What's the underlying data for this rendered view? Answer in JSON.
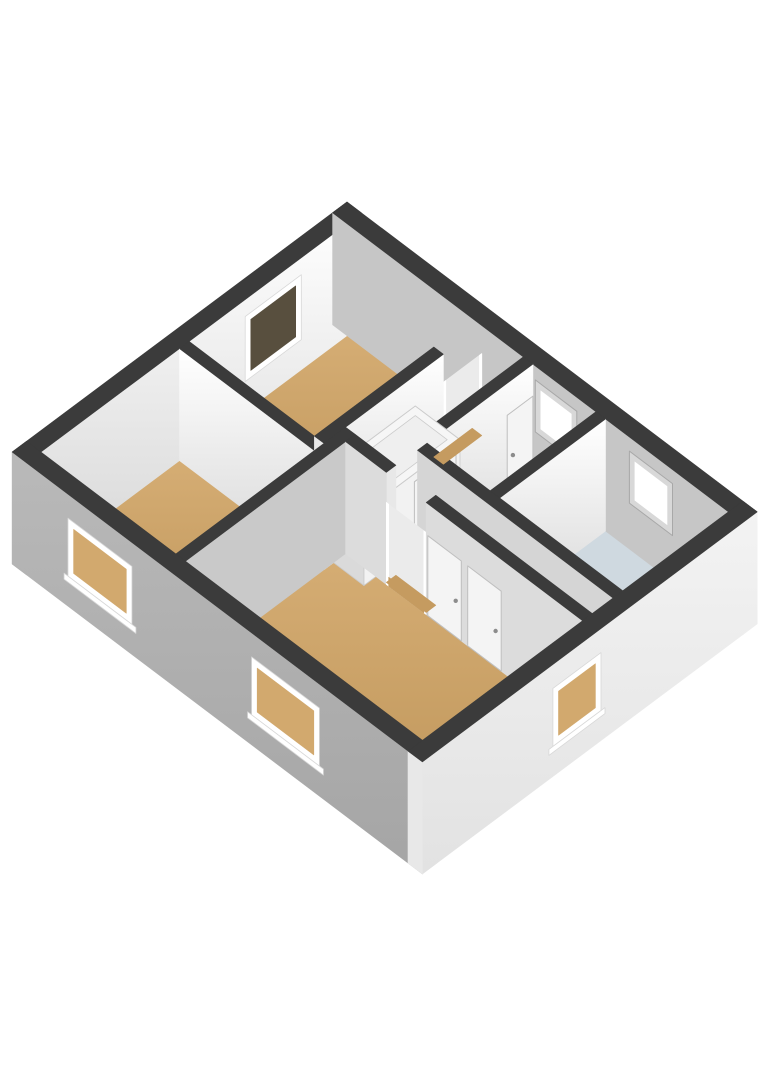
{
  "meta": {
    "view_label": "3d-floorplan-render"
  },
  "canvas": {
    "width": 768,
    "height": 1086,
    "background": "#ffffff"
  },
  "projection": {
    "ox": 347,
    "oy": 202,
    "ux": 0.798,
    "uy": 0.603,
    "vx": -0.801,
    "vy": 0.598,
    "wallH": 112
  },
  "fills": {
    "bg": "#ffffff",
    "wall_top": "#3b3b3b",
    "bright": {
      "grad": [
        "#ffffff",
        "#d6d6d6"
      ]
    },
    "ne_face": "#c6c6c6",
    "gray_face": "#c9c9c9",
    "mid_face": "#dcdcdc",
    "soft_face": "#d5d5d5",
    "sw_ext": {
      "grad": [
        "#b9b9b9",
        "#a5a5a5"
      ]
    },
    "se_ext": {
      "grad": [
        "#f3f3f3",
        "#e2e2e2"
      ]
    },
    "sliver": "#e8e8e8",
    "floor_wood": {
      "grad": [
        "#d5ad74",
        "#bd9458"
      ]
    },
    "floor_hall": "#e2e2e2",
    "floor_bath": "#cfd9e0",
    "glass_dark": "#584f3e",
    "glass_wood": "#d2a96e",
    "glass_white": "#ffffff",
    "frame": "#ffffff",
    "recess": "#d8d8d8",
    "recess_edge": "#a8a8a8",
    "doorway": "#ebebeb",
    "thresh": "#c59b60",
    "leaf": "#f4f4f4",
    "leaf_line": "#bfbfbf",
    "handle": "#8c8c8c",
    "hole": "#c6c6c6",
    "step": "#ffffff",
    "step_line": "#d8d8d8",
    "step_side": "#dadada",
    "step_back": "#f4f4f4",
    "stair_top": "#f6f6f6",
    "stair_inner": "#efefef",
    "stair_edge": "#cbcbcb",
    "stair_px": "#f2f2f2",
    "stair_py": "#dadada"
  },
  "floors": [
    {
      "name": "bedroom-2-floor",
      "fill": "floor_wood",
      "pts": [
        [
          18,
          18
        ],
        [
          175,
          18
        ],
        [
          175,
          215
        ],
        [
          18,
          215
        ]
      ]
    },
    {
      "name": "bedroom-1-floor",
      "fill": "floor_wood",
      "pts": [
        [
          18,
          227
        ],
        [
          187,
          227
        ],
        [
          187,
          400
        ],
        [
          18,
          400
        ]
      ]
    },
    {
      "name": "bedroom-3-floor",
      "fill": "floor_wood",
      "pts": [
        [
          199,
          200
        ],
        [
          496,
          200
        ],
        [
          496,
          400
        ],
        [
          199,
          400
        ]
      ]
    },
    {
      "name": "storage-floor",
      "fill": "floor_wood",
      "pts": [
        [
          251,
          18
        ],
        [
          330,
          18
        ],
        [
          330,
          150
        ],
        [
          251,
          150
        ]
      ]
    },
    {
      "name": "bathroom-floor",
      "fill": "floor_bath",
      "pts": [
        [
          342,
          18
        ],
        [
          496,
          18
        ],
        [
          496,
          150
        ],
        [
          342,
          150
        ]
      ]
    },
    {
      "name": "hallway-floor",
      "fill": "floor_hall",
      "pts": [
        [
          187,
          18
        ],
        [
          239,
          18
        ],
        [
          239,
          162
        ],
        [
          496,
          162
        ],
        [
          496,
          188
        ],
        [
          187,
          188
        ]
      ]
    }
  ],
  "elements": [
    {
      "kind": "wall",
      "name": "nw-exterior-wall",
      "depth": 0,
      "box": [
        0,
        0,
        18,
        418
      ],
      "fills": {
        "px": "bright",
        "py": "sw_ext"
      },
      "attach": [
        {
          "type": "window",
          "name": "nw-window",
          "face": "px",
          "from": 75,
          "to": 145,
          "h0": 30,
          "h1": 95,
          "fw": 7,
          "glass": "glass_dark"
        }
      ]
    },
    {
      "kind": "wall",
      "name": "ne-exterior-wall",
      "depth": 1,
      "box": [
        0,
        0,
        514,
        18
      ],
      "fills": {
        "py": "ne_face",
        "px": "none"
      },
      "attach": [
        {
          "type": "window",
          "name": "ne-window-storage",
          "face": "py",
          "from": 260,
          "to": 300,
          "h0": 52,
          "h1": 92,
          "fw": 6,
          "glass": "glass_white",
          "recess": true
        },
        {
          "type": "window",
          "name": "ne-window-bathroom",
          "face": "py",
          "from": 378,
          "to": 420,
          "h0": 52,
          "h1": 92,
          "fw": 6,
          "glass": "glass_white",
          "recess": true
        }
      ]
    },
    {
      "kind": "doorway",
      "name": "top-bedroom-doorway",
      "depth": 205,
      "plane": "px",
      "at": 187,
      "from": 18,
      "to": 66,
      "h": 84
    },
    {
      "kind": "wall",
      "name": "bedroom2-south-wall",
      "depth": 233,
      "box": [
        18,
        215,
        199,
        227
      ],
      "fills": {
        "py": "bright",
        "px": "sliver"
      }
    },
    {
      "kind": "wall",
      "name": "bedroom2-east-wall",
      "depth": 241,
      "box": [
        175,
        66,
        187,
        215
      ],
      "fills": {
        "px": "bright",
        "py": "sliver"
      }
    },
    {
      "kind": "hole",
      "name": "stairwell-hole",
      "depth": 250,
      "box": [
        189,
        35,
        233,
        95
      ]
    },
    {
      "kind": "steps",
      "name": "stair-steps",
      "depth": 251,
      "x0": 189,
      "x1": 233,
      "treads": [
        [
          47,
          59,
          8
        ],
        [
          59,
          71,
          18
        ],
        [
          71,
          83,
          28
        ],
        [
          83,
          95,
          38
        ]
      ],
      "risers": [
        [
          47,
          0,
          8
        ],
        [
          59,
          8,
          18
        ],
        [
          71,
          18,
          28
        ],
        [
          83,
          28,
          38
        ]
      ],
      "back": [
        95,
        0,
        38
      ],
      "side": [
        [
          47,
          0
        ],
        [
          95,
          38
        ],
        [
          95,
          0
        ]
      ]
    },
    {
      "kind": "wall",
      "name": "hallway-storage-wall",
      "depth": 257,
      "box": [
        239,
        18,
        251,
        162
      ],
      "fills": {
        "px": "bright",
        "py": "sliver"
      },
      "attach": [
        {
          "type": "leaf",
          "name": "storage-door-leaf",
          "face": "px",
          "from": 18,
          "to": 50,
          "h": 80
        }
      ]
    },
    {
      "kind": "stairbox",
      "name": "stair-box",
      "depth": 276,
      "box": [
        181,
        95,
        237,
        215
      ],
      "h": 74,
      "inset": 8,
      "attach": [
        {
          "type": "leaf",
          "name": "stairbox-door-leaf",
          "face": "px",
          "from": 100,
          "to": 152,
          "h": 66
        }
      ]
    },
    {
      "kind": "wall",
      "name": "storage-bathroom-wall",
      "depth": 348,
      "box": [
        330,
        18,
        342,
        162
      ],
      "fills": {
        "px": "bright",
        "py": "sliver"
      }
    },
    {
      "kind": "wall",
      "name": "bedrooms-divider-wall",
      "depth": 375,
      "box": [
        187,
        188,
        199,
        400
      ],
      "fills": {
        "px": "gray_face",
        "py": "sliver"
      }
    },
    {
      "kind": "wall",
      "name": "hall-bedroom3-wall-west",
      "depth": 387,
      "box": [
        199,
        188,
        250,
        200
      ],
      "fills": {
        "py": "mid_face",
        "px": "sliver"
      }
    },
    {
      "kind": "wall",
      "name": "sw-exterior-wall",
      "depth": 400,
      "box": [
        0,
        400,
        514,
        418
      ],
      "fills": {
        "py": "sw_ext",
        "px": "sliver"
      },
      "attach": [
        {
          "type": "window",
          "name": "sw-window-bedroom1",
          "face": "py",
          "from": 70,
          "to": 150,
          "h0": 30,
          "h1": 88,
          "fw": 7,
          "glass": "glass_wood",
          "sill": true
        },
        {
          "type": "window",
          "name": "sw-window-bedroom3",
          "face": "py",
          "from": 300,
          "to": 385,
          "h0": 30,
          "h1": 88,
          "fw": 7,
          "glass": "glass_wood",
          "sill": true
        }
      ]
    },
    {
      "kind": "wall",
      "name": "bathroom-south-wall",
      "depth": 401,
      "box": [
        251,
        150,
        496,
        162
      ],
      "fills": {
        "py": "soft_face",
        "px": "sliver"
      },
      "attach": [
        {
          "type": "leaf",
          "name": "bathroom-door-leaf",
          "face": "py",
          "from": 448,
          "to": 490,
          "h": 80
        }
      ]
    },
    {
      "kind": "doorway",
      "name": "bedroom3-doorway",
      "depth": 438,
      "plane": "py",
      "at": 200,
      "from": 250,
      "to": 300,
      "h": 82
    },
    {
      "kind": "wall",
      "name": "hall-bedroom3-wall-east",
      "depth": 488,
      "box": [
        300,
        188,
        496,
        200
      ],
      "fills": {
        "py": "mid_face",
        "px": "sliver"
      },
      "attach": [
        {
          "type": "leaf",
          "name": "bedroom3-door-leaf",
          "face": "py",
          "from": 302,
          "to": 344,
          "h": 80
        },
        {
          "type": "leaf",
          "name": "bedroom3-closet-leaf",
          "face": "py",
          "from": 352,
          "to": 394,
          "h": 80
        }
      ]
    },
    {
      "kind": "wall",
      "name": "se-exterior-wall",
      "depth": 496,
      "box": [
        496,
        0,
        514,
        418
      ],
      "fills": {
        "px": "se_ext",
        "py": "sliver"
      },
      "attach": [
        {
          "type": "window",
          "name": "se-window-bedroom3",
          "face": "px",
          "from": 195,
          "to": 255,
          "h0": 30,
          "h1": 88,
          "fw": 7,
          "glass": "glass_wood",
          "sill": true
        }
      ]
    }
  ],
  "thresholds": [
    {
      "name": "top-bedroom-threshold",
      "box": [
        175,
        18,
        187,
        66
      ]
    },
    {
      "name": "bedroom3-threshold",
      "box": [
        250,
        188,
        300,
        200
      ]
    }
  ]
}
